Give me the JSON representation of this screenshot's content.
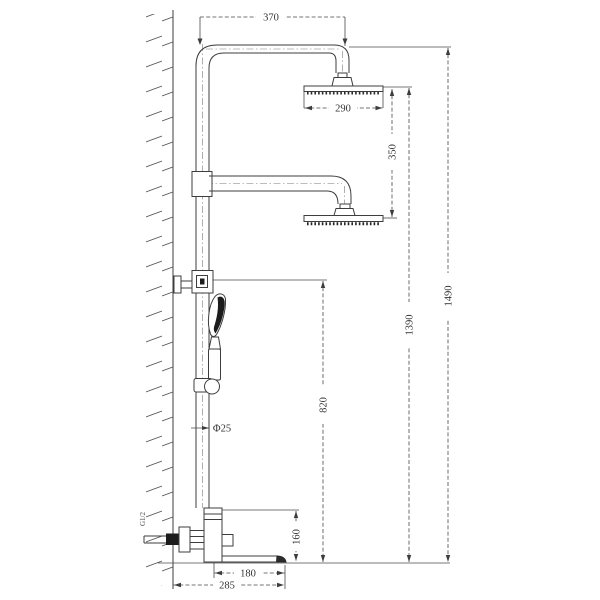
{
  "colors": {
    "background": "#ffffff",
    "ink": "#3d3d3d",
    "dark_fill": "#1c1c1c"
  },
  "dimensions": {
    "top_arm_width": "370",
    "head_width": "290",
    "heads_gap": "350",
    "overall_height": "1490",
    "head_height": "1390",
    "bracket_height": "820",
    "pipe_diameter": "Φ25",
    "spout_block_height": "160",
    "spout_reach": "180",
    "overall_reach": "285",
    "inlet_thread": "G1/2"
  }
}
